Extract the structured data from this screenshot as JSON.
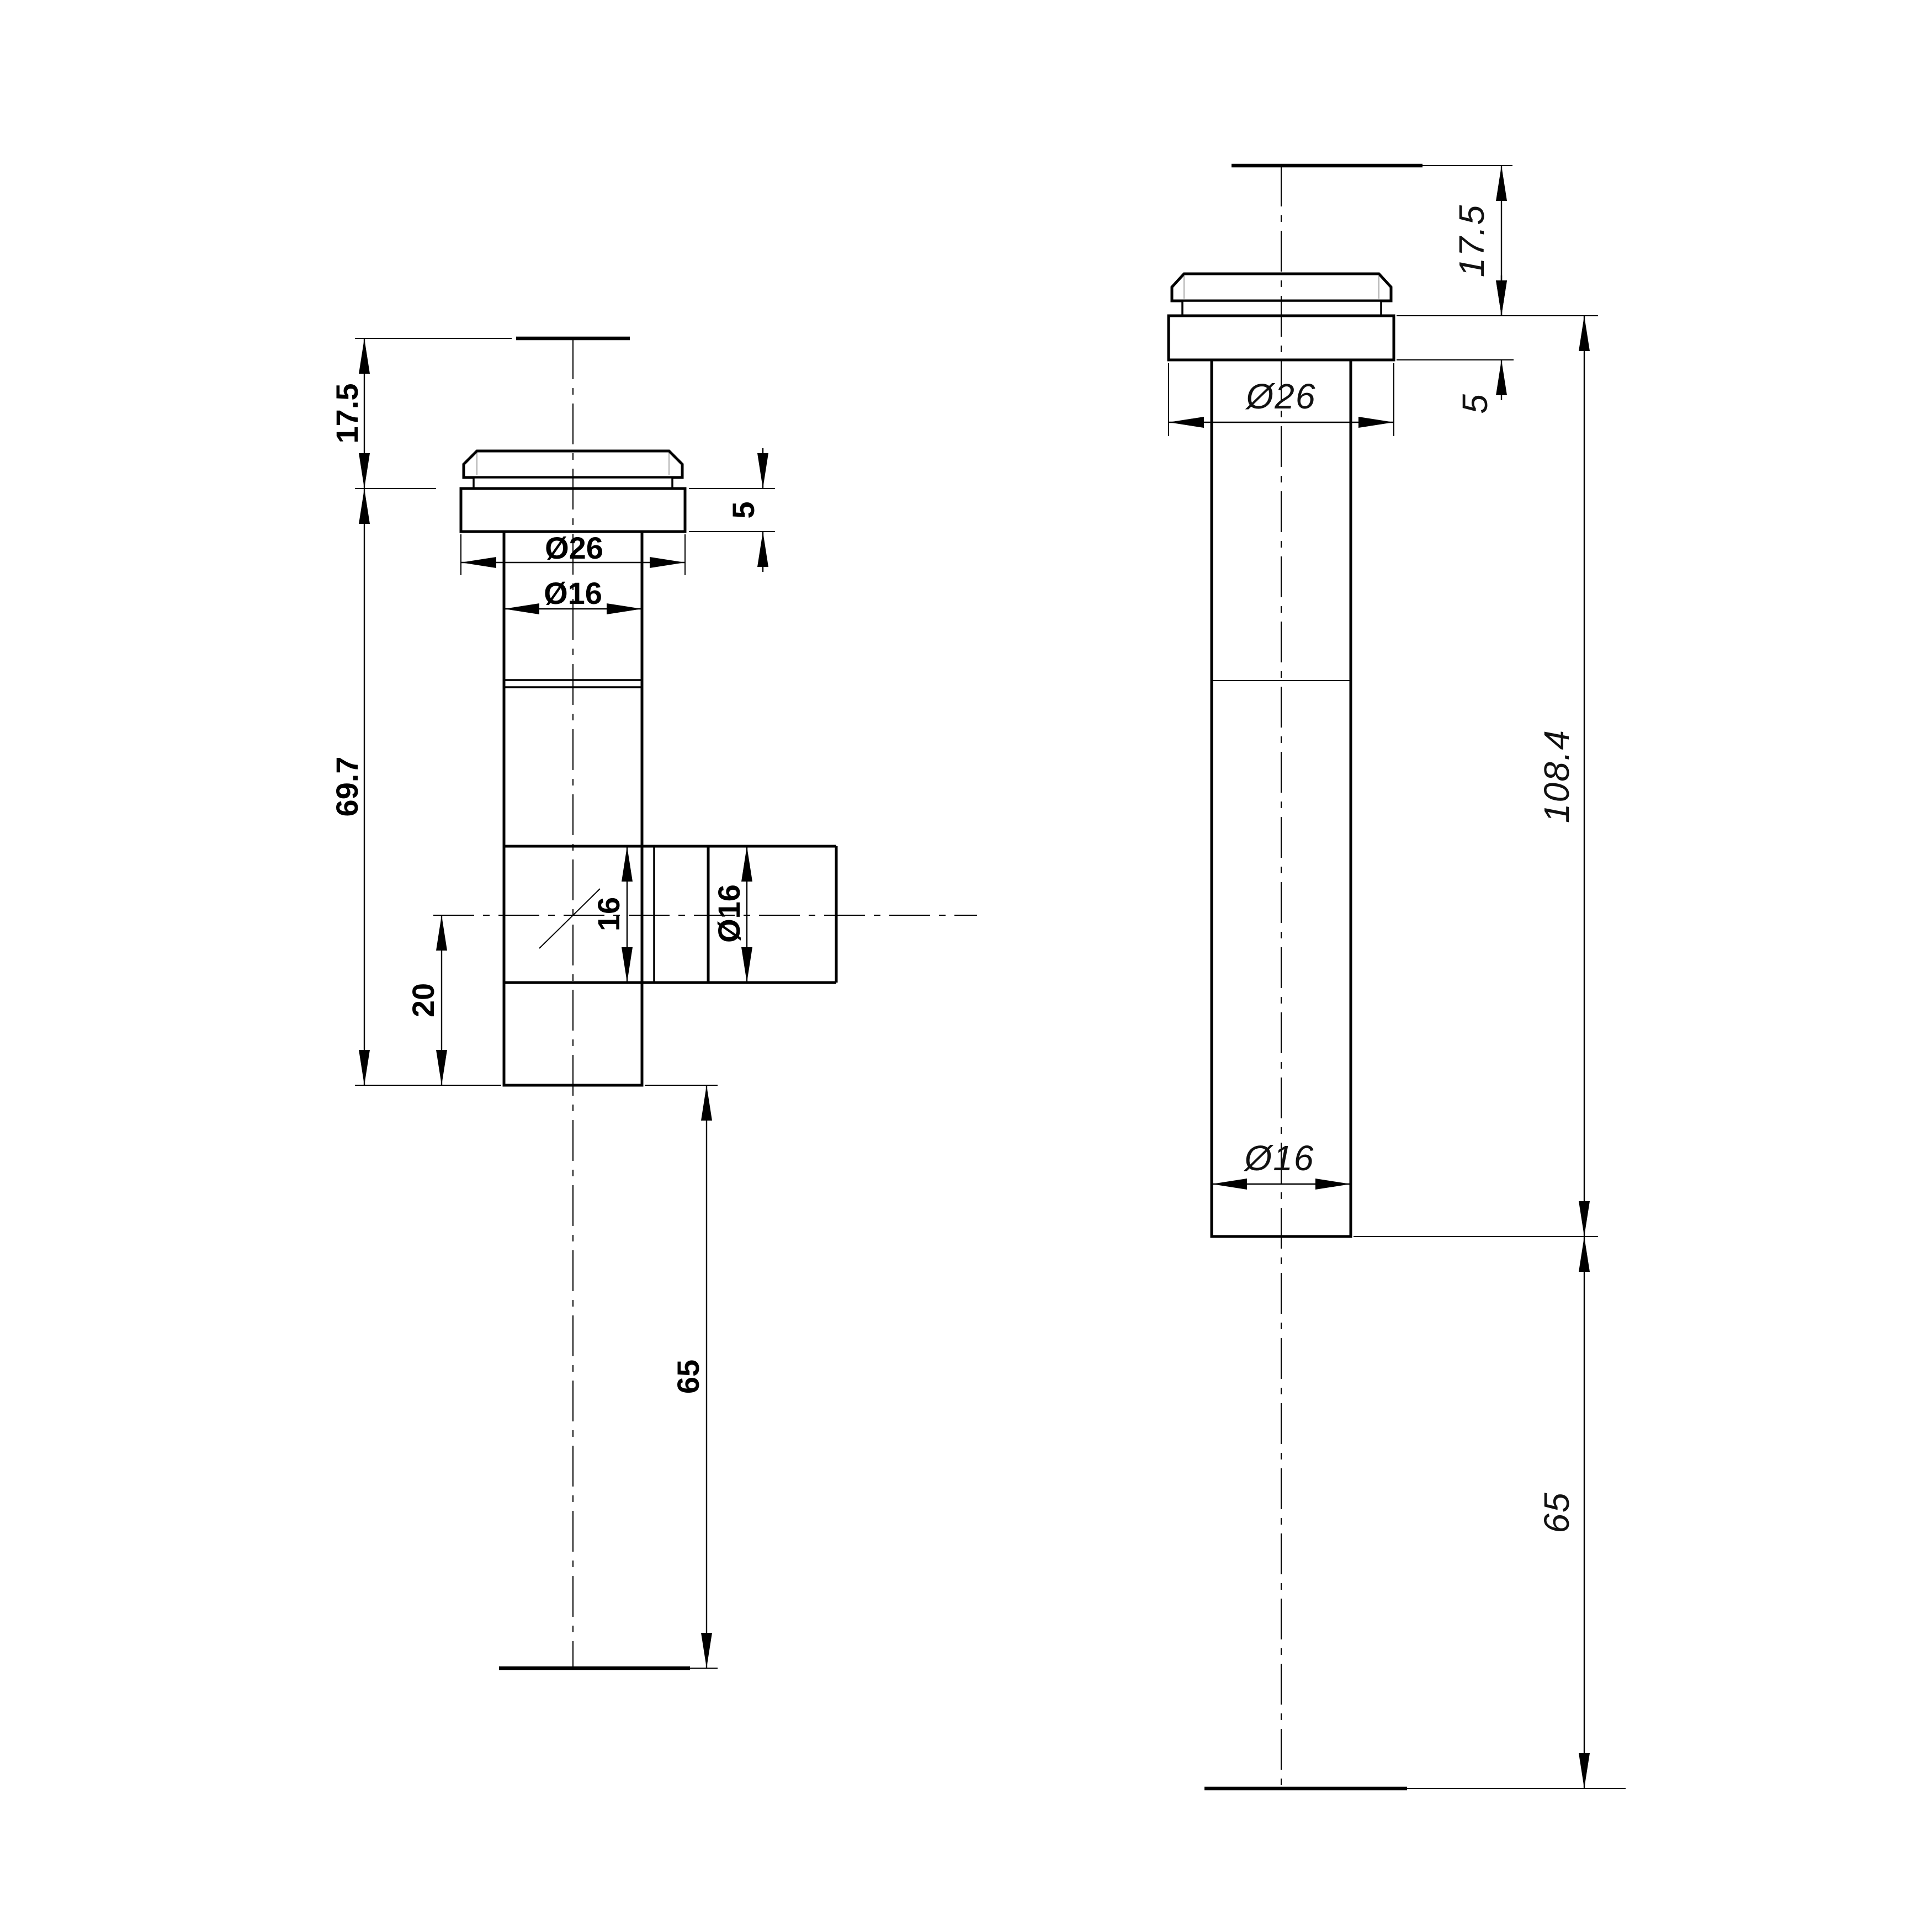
{
  "drawing": {
    "background_color": "#ffffff",
    "line_color": "#000000",
    "views": {
      "left": {
        "name": "front view with side branch",
        "dims": {
          "top_offset": "17.5",
          "body_length": "69.7",
          "branch_center_offset": "20",
          "tail_length": "65",
          "flange_diameter": "Ø26",
          "body_diameter": "Ø16",
          "flange_thickness": "5",
          "branch_bore": "16",
          "branch_diameter": "Ø16"
        }
      },
      "right": {
        "name": "side view",
        "dims": {
          "top_offset": "17.5",
          "flange_thickness": "5",
          "flange_diameter": "Ø26",
          "overall_length": "108.4",
          "body_diameter": "Ø16",
          "tail_length": "65"
        }
      }
    }
  }
}
